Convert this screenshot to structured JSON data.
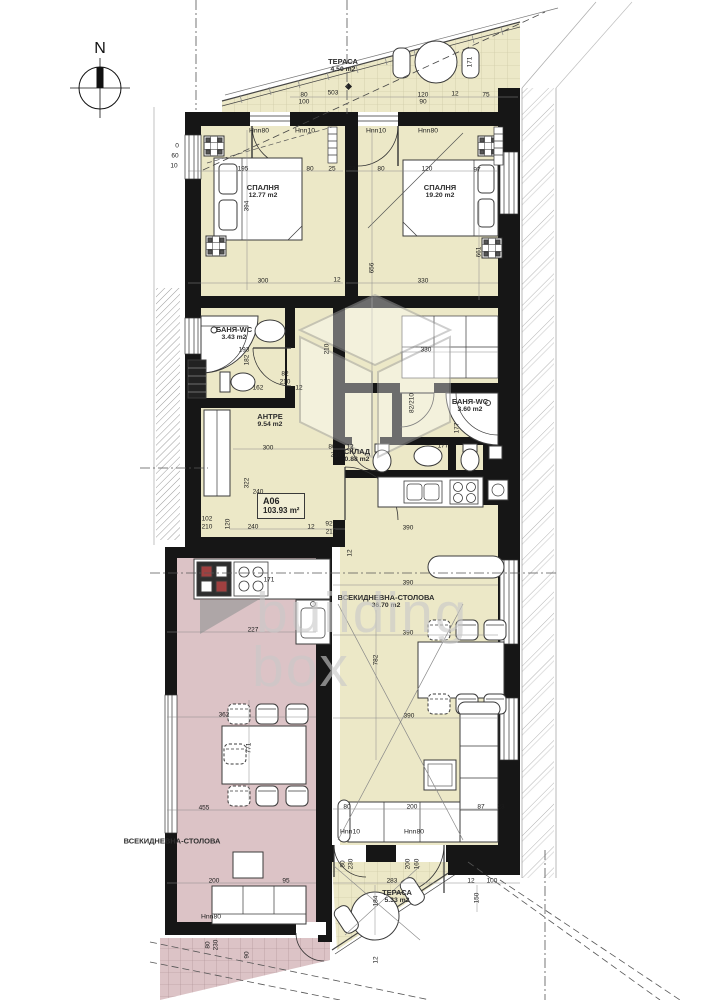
{
  "compass": {
    "label": "N"
  },
  "watermark": {
    "line1": "building",
    "line2": "box"
  },
  "apartment_badge": {
    "id": "A06",
    "area": "103.93 m²"
  },
  "colors": {
    "room_yellow": "#ece8c7",
    "room_pink": "#dcc3c6",
    "wall": "#161616",
    "hatch": "#b3b3b3"
  },
  "rooms": [
    {
      "id": "terrace-top",
      "name": "ТЕРАСА",
      "area": "4.50 m2",
      "x": 343,
      "y": 66
    },
    {
      "id": "bedroom-1",
      "name": "СПАЛНЯ",
      "area": "12.77 m2",
      "x": 263,
      "y": 192
    },
    {
      "id": "bedroom-2",
      "name": "СПАЛНЯ",
      "area": "19.20 m2",
      "x": 440,
      "y": 192
    },
    {
      "id": "bath-1",
      "name": "БАНЯ-WC",
      "area": "3.43 m2",
      "x": 234,
      "y": 334
    },
    {
      "id": "antre",
      "name": "АНТРЕ",
      "area": "9.54 m2",
      "x": 270,
      "y": 421
    },
    {
      "id": "storage",
      "name": "СКЛАД",
      "area": "0.88 m2",
      "x": 357,
      "y": 456
    },
    {
      "id": "bath-2",
      "name": "БАНЯ-WC",
      "area": "3.60 m2",
      "x": 470,
      "y": 406
    },
    {
      "id": "living",
      "name": "ВСЕКИДНЕВНА-СТОЛОВА",
      "area": "36.70 m2",
      "x": 386,
      "y": 602
    },
    {
      "id": "terrace-bottom",
      "name": "ТЕРАСА",
      "area": "5.33 m2",
      "x": 397,
      "y": 897
    },
    {
      "id": "living-neighbor",
      "name": "ВСЕКИДНЕВНА-СТОЛОВА",
      "area": "",
      "x": 172,
      "y": 841
    }
  ],
  "door_labels": [
    {
      "t": "Hnn80",
      "x": 259,
      "y": 131
    },
    {
      "t": "Hnn10",
      "x": 305,
      "y": 131
    },
    {
      "t": "Hnn10",
      "x": 376,
      "y": 131
    },
    {
      "t": "Hnn80",
      "x": 428,
      "y": 131
    },
    {
      "t": "Hnn10",
      "x": 350,
      "y": 832
    },
    {
      "t": "Hnn80",
      "x": 414,
      "y": 832
    },
    {
      "t": "Hnn80",
      "x": 211,
      "y": 917
    }
  ],
  "dims": [
    {
      "t": "503",
      "x": 333,
      "y": 93
    },
    {
      "t": "80",
      "x": 304,
      "y": 95
    },
    {
      "t": "100",
      "x": 304,
      "y": 102
    },
    {
      "t": "120",
      "x": 423,
      "y": 95
    },
    {
      "t": "90",
      "x": 423,
      "y": 102
    },
    {
      "t": "12",
      "x": 455,
      "y": 94
    },
    {
      "t": "75",
      "x": 486,
      "y": 95
    },
    {
      "t": "171",
      "x": 470,
      "y": 62,
      "r": 1
    },
    {
      "t": "0",
      "x": 177,
      "y": 146
    },
    {
      "t": "60",
      "x": 175,
      "y": 156
    },
    {
      "t": "10",
      "x": 174,
      "y": 166
    },
    {
      "t": "195",
      "x": 243,
      "y": 169
    },
    {
      "t": "80",
      "x": 310,
      "y": 169
    },
    {
      "t": "25",
      "x": 332,
      "y": 169
    },
    {
      "t": "394",
      "x": 247,
      "y": 206,
      "r": 1
    },
    {
      "t": "300",
      "x": 263,
      "y": 281
    },
    {
      "t": "12",
      "x": 337,
      "y": 280
    },
    {
      "t": "23",
      "x": 352,
      "y": 169
    },
    {
      "t": "80",
      "x": 381,
      "y": 169
    },
    {
      "t": "120",
      "x": 427,
      "y": 169
    },
    {
      "t": "97",
      "x": 477,
      "y": 170
    },
    {
      "t": "656",
      "x": 372,
      "y": 268,
      "r": 1
    },
    {
      "t": "330",
      "x": 423,
      "y": 281
    },
    {
      "t": "661",
      "x": 479,
      "y": 252,
      "r": 1
    },
    {
      "t": "193",
      "x": 244,
      "y": 350
    },
    {
      "t": "182",
      "x": 247,
      "y": 360,
      "r": 1
    },
    {
      "t": "82",
      "x": 285,
      "y": 374
    },
    {
      "t": "210",
      "x": 285,
      "y": 382
    },
    {
      "t": "162",
      "x": 258,
      "y": 388
    },
    {
      "t": "12",
      "x": 299,
      "y": 388
    },
    {
      "t": "210",
      "x": 327,
      "y": 349,
      "r": 1
    },
    {
      "t": "300",
      "x": 268,
      "y": 448
    },
    {
      "t": "80",
      "x": 332,
      "y": 447
    },
    {
      "t": "12",
      "x": 350,
      "y": 447
    },
    {
      "t": "210",
      "x": 336,
      "y": 455
    },
    {
      "t": "322",
      "x": 247,
      "y": 483,
      "r": 1
    },
    {
      "t": "240",
      "x": 258,
      "y": 492
    },
    {
      "t": "102",
      "x": 207,
      "y": 519
    },
    {
      "t": "210",
      "x": 207,
      "y": 527
    },
    {
      "t": "120",
      "x": 228,
      "y": 524,
      "r": 1
    },
    {
      "t": "240",
      "x": 253,
      "y": 527
    },
    {
      "t": "12",
      "x": 311,
      "y": 527
    },
    {
      "t": "92",
      "x": 329,
      "y": 524
    },
    {
      "t": "210",
      "x": 331,
      "y": 532
    },
    {
      "t": "12",
      "x": 350,
      "y": 553,
      "r": 1
    },
    {
      "t": "330",
      "x": 426,
      "y": 350
    },
    {
      "t": "82/210",
      "x": 412,
      "y": 403,
      "r": 1
    },
    {
      "t": "177",
      "x": 457,
      "y": 428,
      "r": 1
    },
    {
      "t": "177",
      "x": 443,
      "y": 446
    },
    {
      "t": "390",
      "x": 408,
      "y": 528
    },
    {
      "t": "390",
      "x": 408,
      "y": 583
    },
    {
      "t": "390",
      "x": 408,
      "y": 633
    },
    {
      "t": "782",
      "x": 376,
      "y": 660,
      "r": 1
    },
    {
      "t": "390",
      "x": 409,
      "y": 716
    },
    {
      "t": "80",
      "x": 347,
      "y": 807
    },
    {
      "t": "200",
      "x": 412,
      "y": 807
    },
    {
      "t": "87",
      "x": 481,
      "y": 807
    },
    {
      "t": "23",
      "x": 501,
      "y": 807
    },
    {
      "t": "283",
      "x": 392,
      "y": 881
    },
    {
      "t": "12",
      "x": 471,
      "y": 881
    },
    {
      "t": "100",
      "x": 492,
      "y": 881
    },
    {
      "t": "150",
      "x": 477,
      "y": 898,
      "r": 1
    },
    {
      "t": "184",
      "x": 376,
      "y": 901,
      "r": 1
    },
    {
      "t": "200",
      "x": 408,
      "y": 864,
      "r": 1
    },
    {
      "t": "160",
      "x": 417,
      "y": 864,
      "r": 1
    },
    {
      "t": "80",
      "x": 343,
      "y": 864,
      "r": 1
    },
    {
      "t": "230",
      "x": 351,
      "y": 864,
      "r": 1
    },
    {
      "t": "12",
      "x": 376,
      "y": 960,
      "r": 1
    },
    {
      "t": "171",
      "x": 269,
      "y": 580
    },
    {
      "t": "227",
      "x": 253,
      "y": 630
    },
    {
      "t": "362",
      "x": 224,
      "y": 715
    },
    {
      "t": "771",
      "x": 249,
      "y": 748,
      "r": 1
    },
    {
      "t": "455",
      "x": 204,
      "y": 808
    },
    {
      "t": "200",
      "x": 214,
      "y": 881
    },
    {
      "t": "95",
      "x": 286,
      "y": 881
    },
    {
      "t": "80",
      "x": 208,
      "y": 945,
      "r": 1
    },
    {
      "t": "230",
      "x": 216,
      "y": 945,
      "r": 1
    },
    {
      "t": "90",
      "x": 247,
      "y": 955,
      "r": 1
    }
  ]
}
